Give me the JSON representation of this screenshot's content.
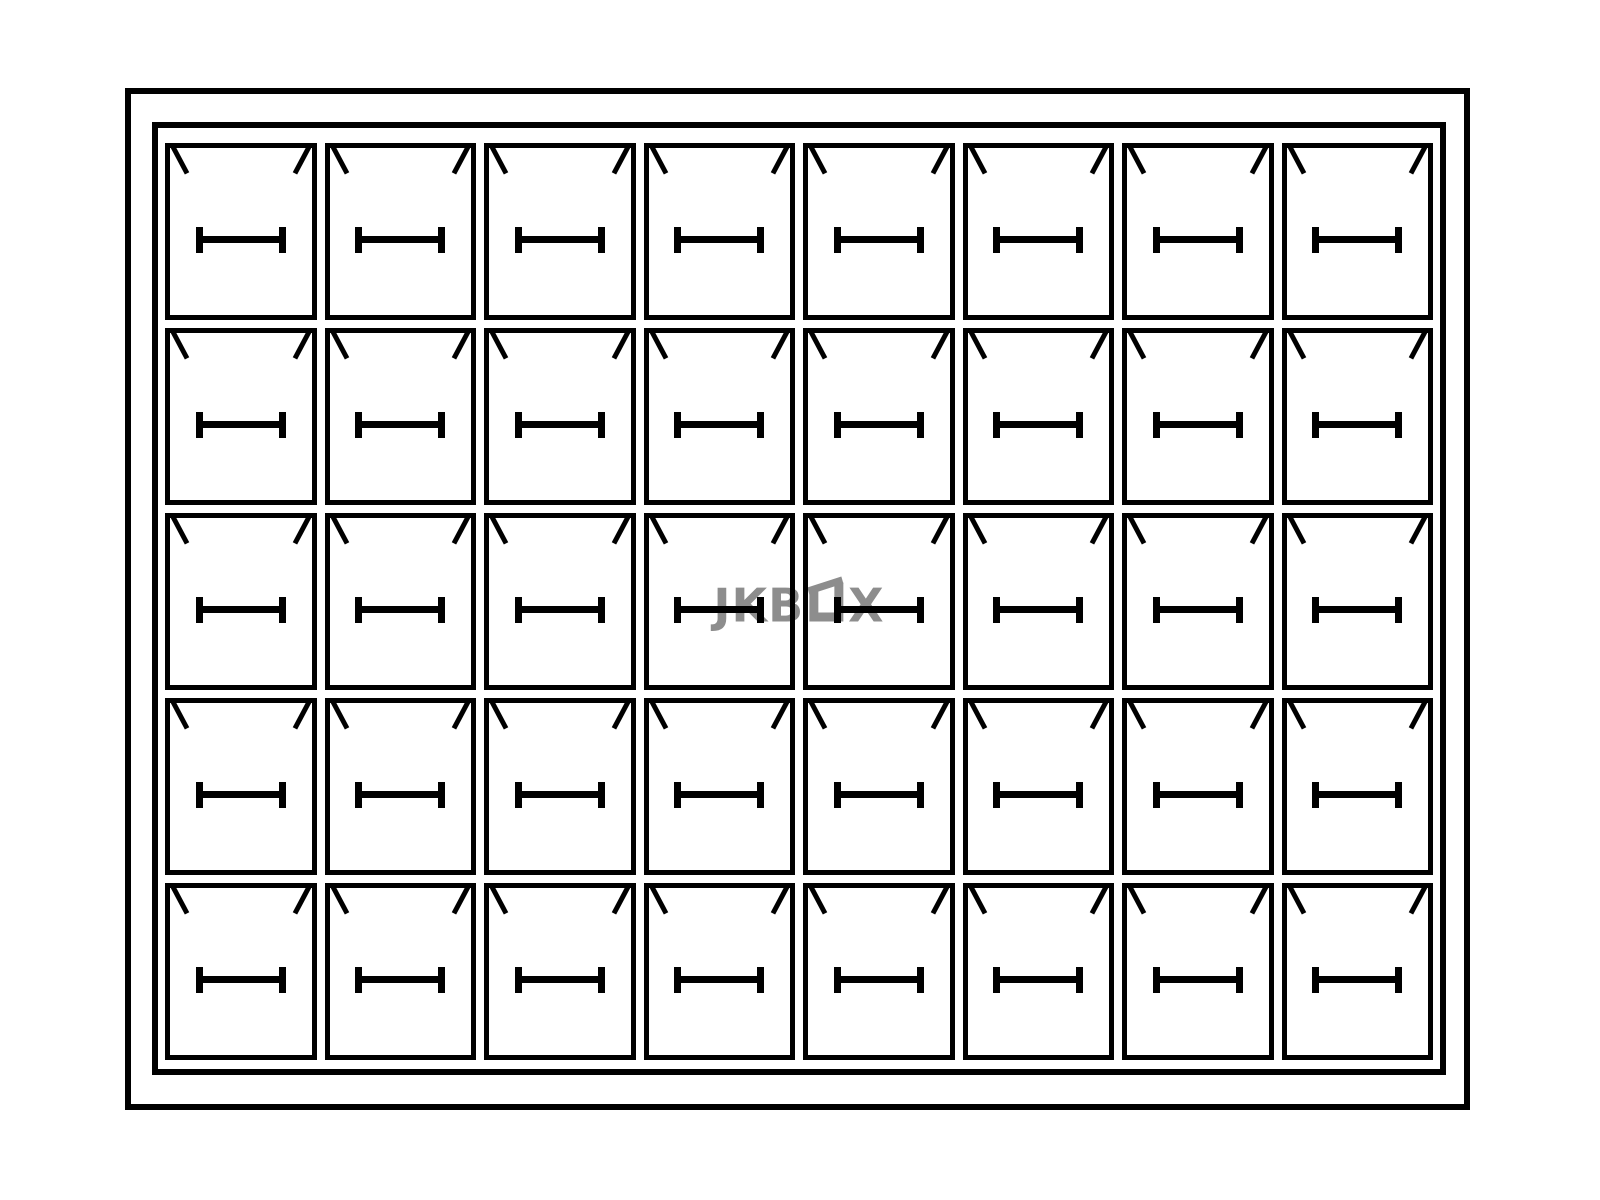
{
  "watermark": {
    "full_text": "JKBOX",
    "prefix": "JKB",
    "suffix": "X",
    "color": "#8d8d8d"
  },
  "grid": {
    "rows": 5,
    "columns": 8,
    "cell_count": 40
  },
  "symbols": {
    "corner_mark": "diagonal-tick-at-top-corner",
    "slot_mark": "horizontal-bar-with-end-caps"
  },
  "colors": {
    "line": "#000000",
    "background": "#ffffff"
  }
}
